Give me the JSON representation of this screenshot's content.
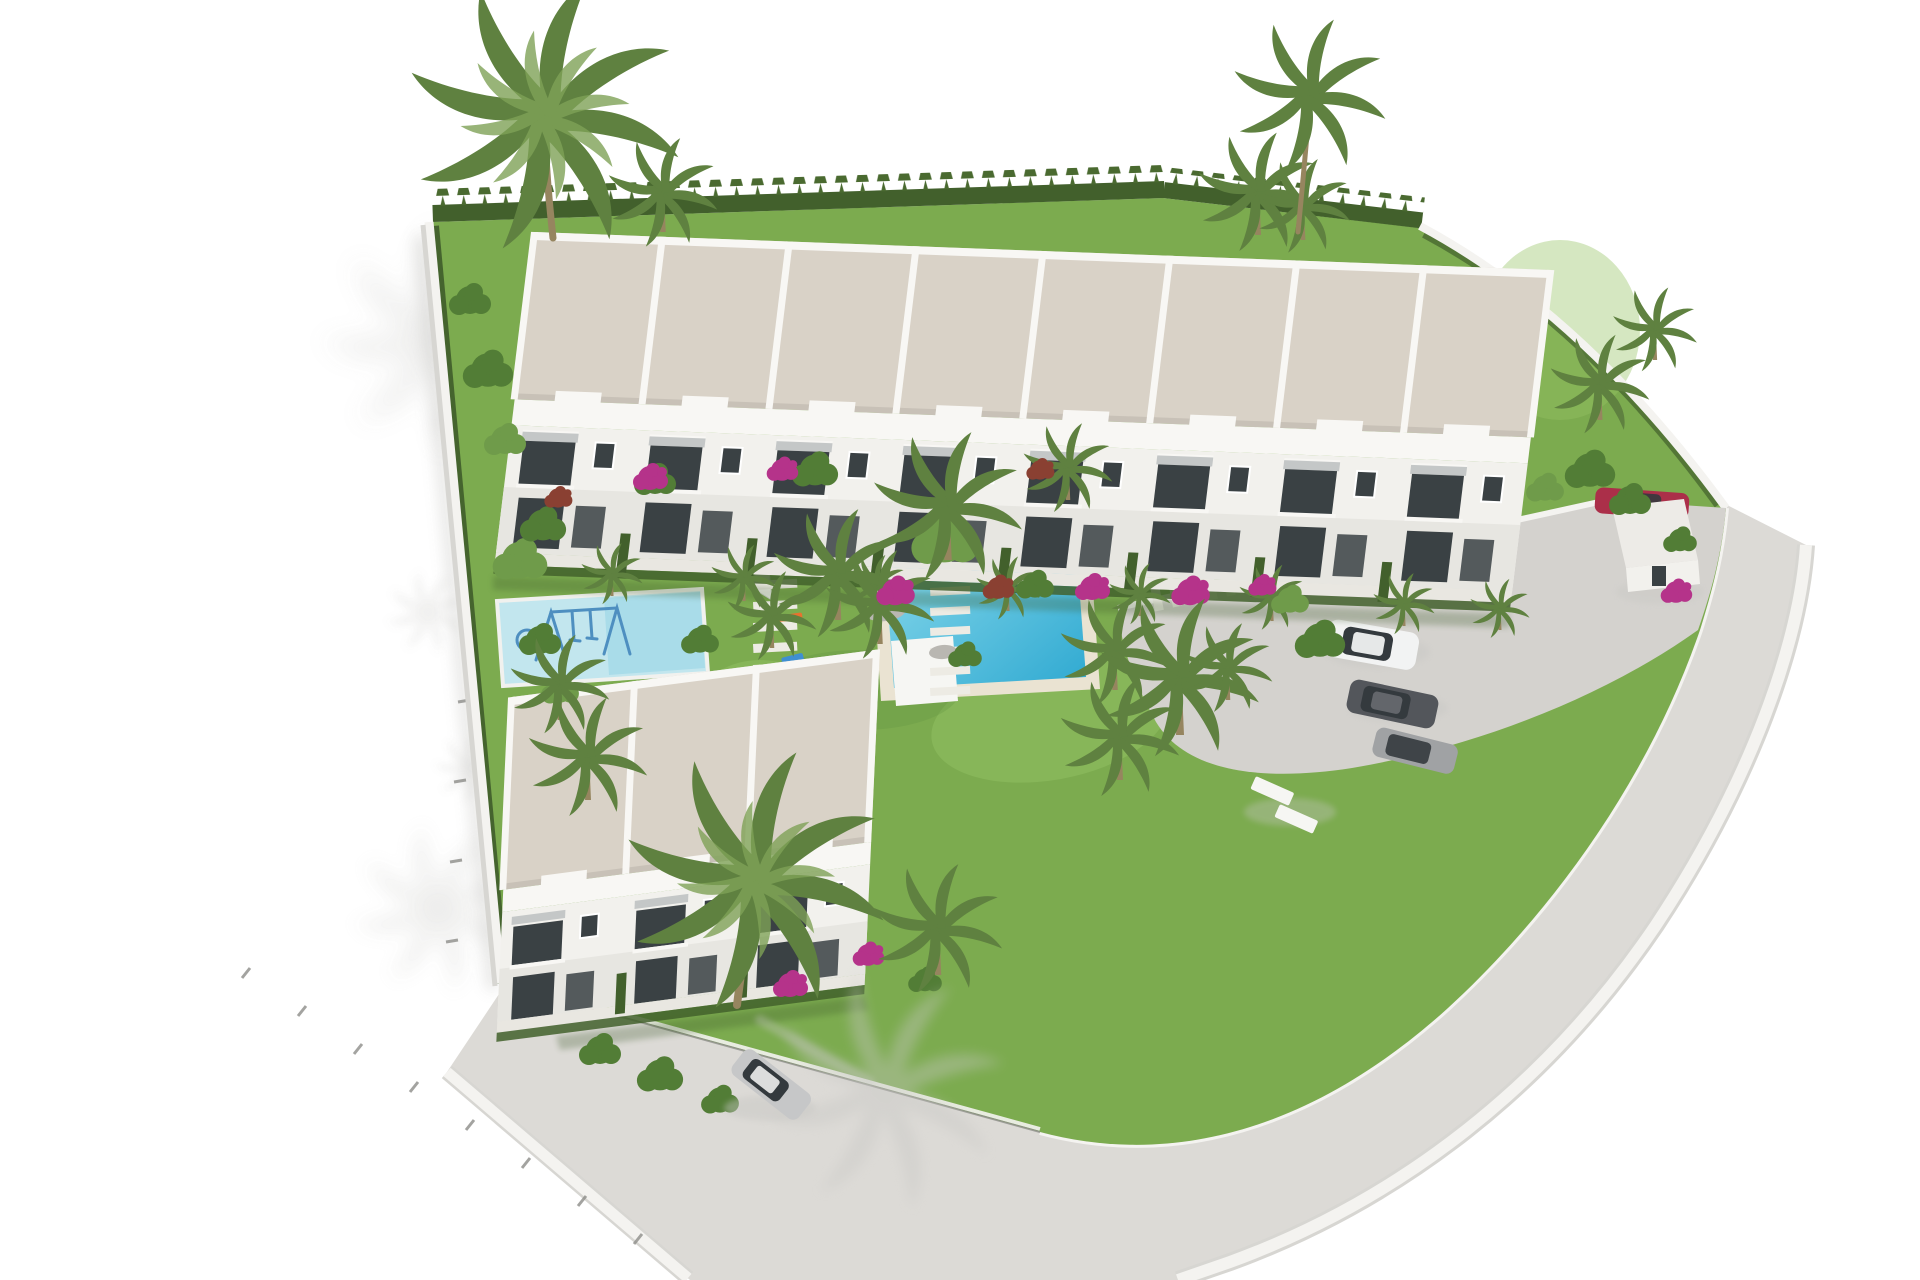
{
  "scene": {
    "type": "3d-architectural-render",
    "view": "aerial-isometric",
    "subject": "New-build residential complex of white two-storey townhouses with communal pool, kids splash pool, landscaped gardens, gated entrance and parking",
    "background": "white unrendered surroundings with soft palm-tree shadows",
    "upper_row": {
      "units": 8,
      "stories": 2,
      "roof": "flat beige gravel roofs separated by white parapets"
    },
    "lower_block": {
      "units": 3,
      "stories": 2,
      "roof": "flat beige gravel roofs separated by white parapets"
    },
    "amenities": [
      "communal swimming pool",
      "kids splash pool with swing set and climbing dome",
      "sun loungers",
      "stepping-stone garden paths",
      "bougainvillea and palm landscaping",
      "cypress perimeter hedge",
      "perimeter wall with wire fence",
      "entrance gatehouse",
      "paved parking area"
    ],
    "vehicles": [
      {
        "name": "white-suv",
        "area": "parking"
      },
      {
        "name": "dark-gray-car",
        "area": "parking"
      },
      {
        "name": "gray-car",
        "area": "parking"
      },
      {
        "name": "red-car",
        "area": "entrance"
      },
      {
        "name": "silver-car",
        "area": "street"
      }
    ]
  },
  "colors": {
    "background": "#ffffff",
    "shadow": "#c8c7c4",
    "grass": "#7cab4f",
    "grass_light": "#95c365",
    "grass_dark": "#639641",
    "hedge": "#42602c",
    "cypress": "#4a6a30",
    "bush": "#527d36",
    "tree": "#6f9b4a",
    "palm": "#5f8140",
    "palm_light": "#7fa257",
    "trunk": "#96855f",
    "roof": "#d9d2c7",
    "facade": "#f2f1ed",
    "facade_shade": "#e7e6e1",
    "parapet": "#f8f7f4",
    "window": "#3a4144",
    "awning": "#c4c7c7",
    "walkway": "#e9e7e1",
    "path_stone": "#edebe4",
    "wall": "#f4f3f0",
    "wall_shade": "#d7d6d2",
    "road": "#dcdad6",
    "parking": "#d4d2ce",
    "pool_coping": "#eae3d2",
    "pool_water": "#2fa9d1",
    "pool_water_light": "#90ddee",
    "kids_pad": "#c2e6ee",
    "kids_water": "#a9dce9",
    "bougainvillea": "#b5338a",
    "flower_red": "#8a4032",
    "car_white": "#f2f3f3",
    "car_dark": "#53565b",
    "car_gray": "#a0a2a4",
    "car_red": "#ab2f49",
    "car_street": "#c6c7c8",
    "glass": "#343a3e",
    "fence": "#8d8d89",
    "lounger": "#f6f6f3",
    "lounger_orange": "#e8722e",
    "toy_blue": "#3f8fd2",
    "swing_blue": "#4e8fc0",
    "sail": "#fbfbf8"
  }
}
